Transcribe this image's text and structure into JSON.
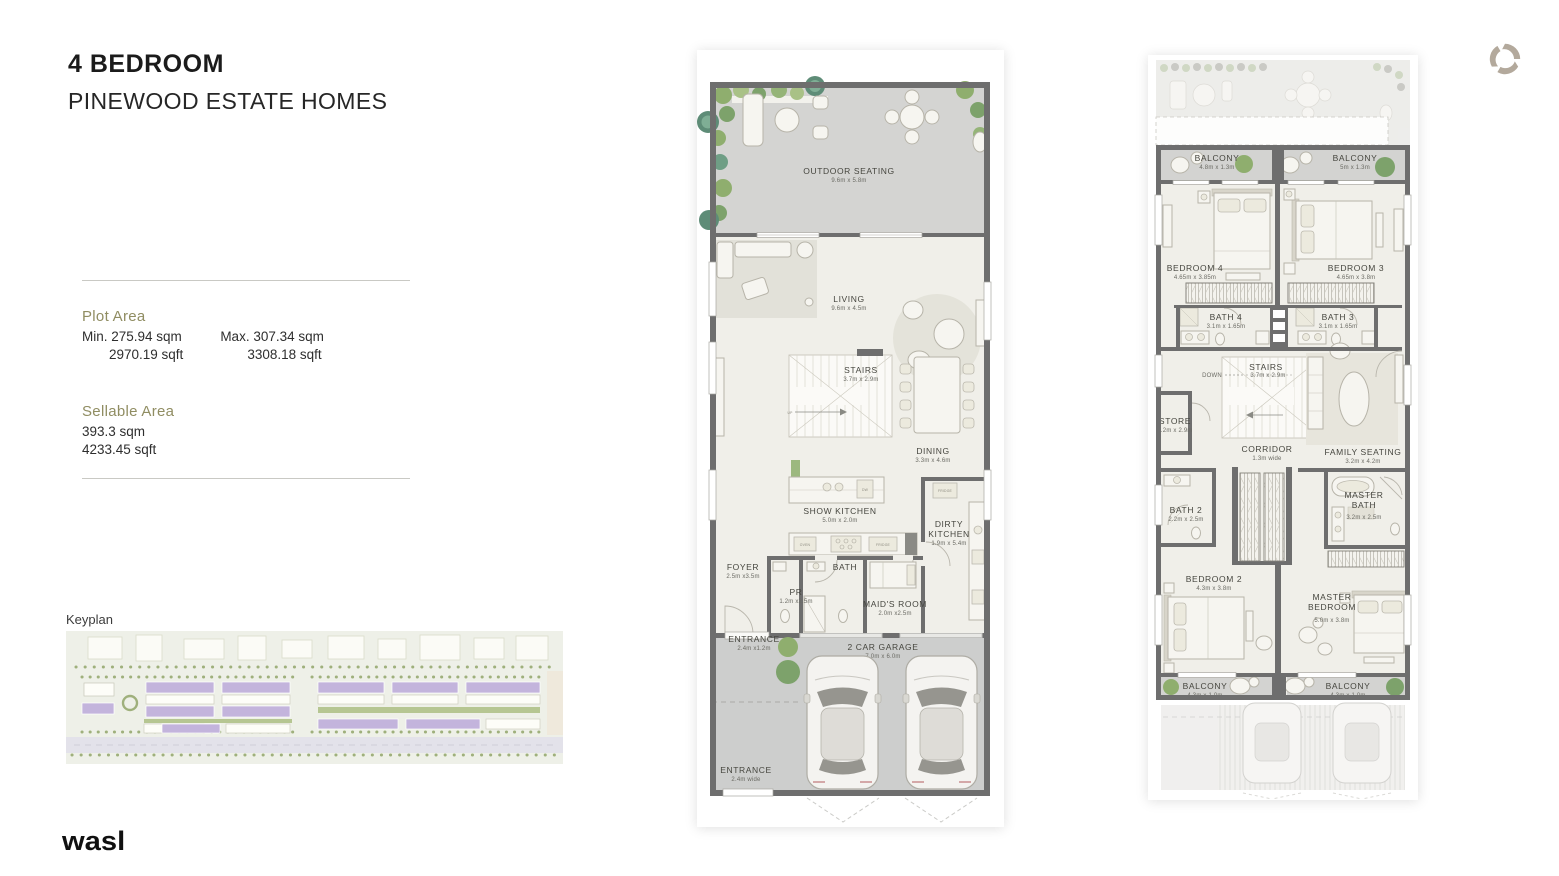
{
  "header": {
    "title": "4 BEDROOM",
    "subtitle": "PINEWOOD ESTATE HOMES"
  },
  "plot": {
    "label": "Plot Area",
    "min_sqm": "Min. 275.94 sqm",
    "min_sqft": "2970.19 sqft",
    "max_sqm": "Max. 307.34 sqm",
    "max_sqft": "3308.18 sqft"
  },
  "sellable": {
    "label": "Sellable Area",
    "sqm": "393.3 sqm",
    "sqft": "4233.45 sqft"
  },
  "keyplan": {
    "label": "Keyplan"
  },
  "brand": {
    "logo_text": "wasl"
  },
  "colors": {
    "accent_olive": "#908d62",
    "wall_gray": "#6e6e6e",
    "floor_cream": "#f0efe9",
    "outdoor_gray": "#d4d4d2",
    "keyplan_purple": "#c3b4dc",
    "tree_green": "#8fae6e",
    "swirl_taupe": "#b3a99c"
  },
  "gf": {
    "labels": {
      "up": "UP",
      "oven": "OVEN",
      "fridge": "FRIDGE",
      "dw": "DW"
    },
    "rooms": [
      {
        "name": "OUTDOOR SEATING",
        "dims": "9.6m x 5.8m"
      },
      {
        "name": "LIVING",
        "dims": "9.6m x 4.5m"
      },
      {
        "name": "STAIRS",
        "dims": "3.7m x 2.9m"
      },
      {
        "name": "DINING",
        "dims": "3.3m x 4.6m"
      },
      {
        "name": "SHOW KITCHEN",
        "dims": "5.0m x 2.0m"
      },
      {
        "name": "DIRTY KITCHEN",
        "dims": "1.9m x 5.4m"
      },
      {
        "name": "FOYER",
        "dims": "2.5m x3.5m"
      },
      {
        "name": "PR",
        "dims": "1.2m x2.5m"
      },
      {
        "name": "BATH",
        "dims": ""
      },
      {
        "name": "MAID'S ROOM",
        "dims": "2.0m x2.5m"
      },
      {
        "name": "ENTRANCE",
        "dims": "2.4m x1.2m"
      },
      {
        "name": "2 CAR GARAGE",
        "dims": "7.0m x 6.0m"
      },
      {
        "name": "ENTRANCE",
        "dims": "2.4m wide"
      }
    ]
  },
  "ff": {
    "down_label": "DOWN",
    "rooms": [
      {
        "name": "BALCONY",
        "dims": "4.8m x 1.3m"
      },
      {
        "name": "BALCONY",
        "dims": "5m x 1.3m"
      },
      {
        "name": "BEDROOM 4",
        "dims": "4.65m x 3.85m"
      },
      {
        "name": "BEDROOM 3",
        "dims": "4.65m x 3.8m"
      },
      {
        "name": "BATH 4",
        "dims": "3.1m x 1.65m"
      },
      {
        "name": "BATH 3",
        "dims": "3.1m x 1.65m"
      },
      {
        "name": "STAIRS",
        "dims": "3.7m x 2.9m"
      },
      {
        "name": "STORE",
        "dims": "1.2m x 2.9m"
      },
      {
        "name": "CORRIDOR",
        "dims": "1.3m wide"
      },
      {
        "name": "FAMILY SEATING",
        "dims": "3.2m x 4.2m"
      },
      {
        "name": "BATH 2",
        "dims": "2.2m x 2.5m"
      },
      {
        "name": "MASTER BATH",
        "dims": "3.2m x 2.5m"
      },
      {
        "name": "BEDROOM 2",
        "dims": "4.3m x 3.8m"
      },
      {
        "name": "MASTER BEDROOM",
        "dims": "5.0m x 3.8m"
      },
      {
        "name": "BALCONY",
        "dims": "4.3m x 1.0m"
      },
      {
        "name": "BALCONY",
        "dims": "4.3m x 1.0m"
      }
    ]
  }
}
